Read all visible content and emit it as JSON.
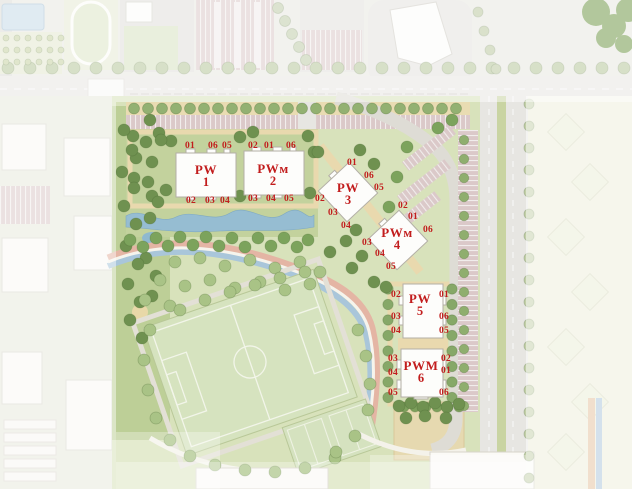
{
  "page": {
    "title": "Residential complex master plan (site plan)"
  },
  "colors": {
    "unit_label": "#c21d1d",
    "building_fill": "#fdfdfb",
    "lawn": "#d8e2bb",
    "tree_dark": "#6f9150",
    "water": "#96bdd2",
    "road": "#e7e6e2",
    "parking": "#dbc9c9",
    "path_tan": "#e9d9ae",
    "median_green": "#c9d4a2"
  },
  "map": {
    "features": [
      "horizontal-street",
      "vertical-street",
      "street-parking-row",
      "diagonal-parking",
      "football-field",
      "training-fields",
      "stream",
      "promenade-path",
      "garden-courtyard",
      "park-strip",
      "pond",
      "playground",
      "running-track",
      "swimming-pool",
      "parking-lot",
      "neighboring-blocks-faded"
    ],
    "buildings": [
      {
        "name": "PW",
        "number": "1",
        "name_pos": {
          "x": 206,
          "y": 176
        },
        "units": [
          {
            "label": "01",
            "x": 190,
            "y": 146
          },
          {
            "label": "06",
            "x": 213,
            "y": 146
          },
          {
            "label": "05",
            "x": 227,
            "y": 146
          },
          {
            "label": "02",
            "x": 191,
            "y": 201
          },
          {
            "label": "03",
            "x": 210,
            "y": 201
          },
          {
            "label": "04",
            "x": 225,
            "y": 201
          }
        ]
      },
      {
        "name": "PWм",
        "number": "2",
        "name_pos": {
          "x": 273,
          "y": 175
        },
        "units": [
          {
            "label": "02",
            "x": 253,
            "y": 146
          },
          {
            "label": "01",
            "x": 269,
            "y": 146
          },
          {
            "label": "06",
            "x": 291,
            "y": 146
          },
          {
            "label": "03",
            "x": 253,
            "y": 199
          },
          {
            "label": "04",
            "x": 271,
            "y": 199
          },
          {
            "label": "05",
            "x": 289,
            "y": 199
          }
        ]
      },
      {
        "name": "PW",
        "number": "3",
        "name_pos": {
          "x": 348,
          "y": 194
        },
        "units": [
          {
            "label": "01",
            "x": 352,
            "y": 163
          },
          {
            "label": "06",
            "x": 369,
            "y": 176
          },
          {
            "label": "05",
            "x": 379,
            "y": 188
          },
          {
            "label": "02",
            "x": 320,
            "y": 199
          },
          {
            "label": "03",
            "x": 333,
            "y": 213
          },
          {
            "label": "04",
            "x": 346,
            "y": 226
          }
        ]
      },
      {
        "name": "PWм",
        "number": "4",
        "name_pos": {
          "x": 397,
          "y": 239
        },
        "units": [
          {
            "label": "02",
            "x": 403,
            "y": 206
          },
          {
            "label": "01",
            "x": 413,
            "y": 217
          },
          {
            "label": "06",
            "x": 428,
            "y": 230
          },
          {
            "label": "03",
            "x": 367,
            "y": 243
          },
          {
            "label": "04",
            "x": 380,
            "y": 254
          },
          {
            "label": "05",
            "x": 391,
            "y": 267
          }
        ]
      },
      {
        "name": "PW",
        "number": "5",
        "name_pos": {
          "x": 420,
          "y": 305
        },
        "units": [
          {
            "label": "02",
            "x": 396,
            "y": 295
          },
          {
            "label": "01",
            "x": 444,
            "y": 295
          },
          {
            "label": "03",
            "x": 396,
            "y": 317
          },
          {
            "label": "06",
            "x": 444,
            "y": 317
          },
          {
            "label": "04",
            "x": 396,
            "y": 331
          },
          {
            "label": "05",
            "x": 444,
            "y": 331
          }
        ]
      },
      {
        "name": "PWM",
        "number": "6",
        "name_pos": {
          "x": 421,
          "y": 372
        },
        "units": [
          {
            "label": "03",
            "x": 393,
            "y": 359
          },
          {
            "label": "02",
            "x": 446,
            "y": 359
          },
          {
            "label": "04",
            "x": 393,
            "y": 373
          },
          {
            "label": "01",
            "x": 446,
            "y": 371
          },
          {
            "label": "05",
            "x": 393,
            "y": 393
          },
          {
            "label": "06",
            "x": 444,
            "y": 393
          }
        ]
      }
    ]
  }
}
